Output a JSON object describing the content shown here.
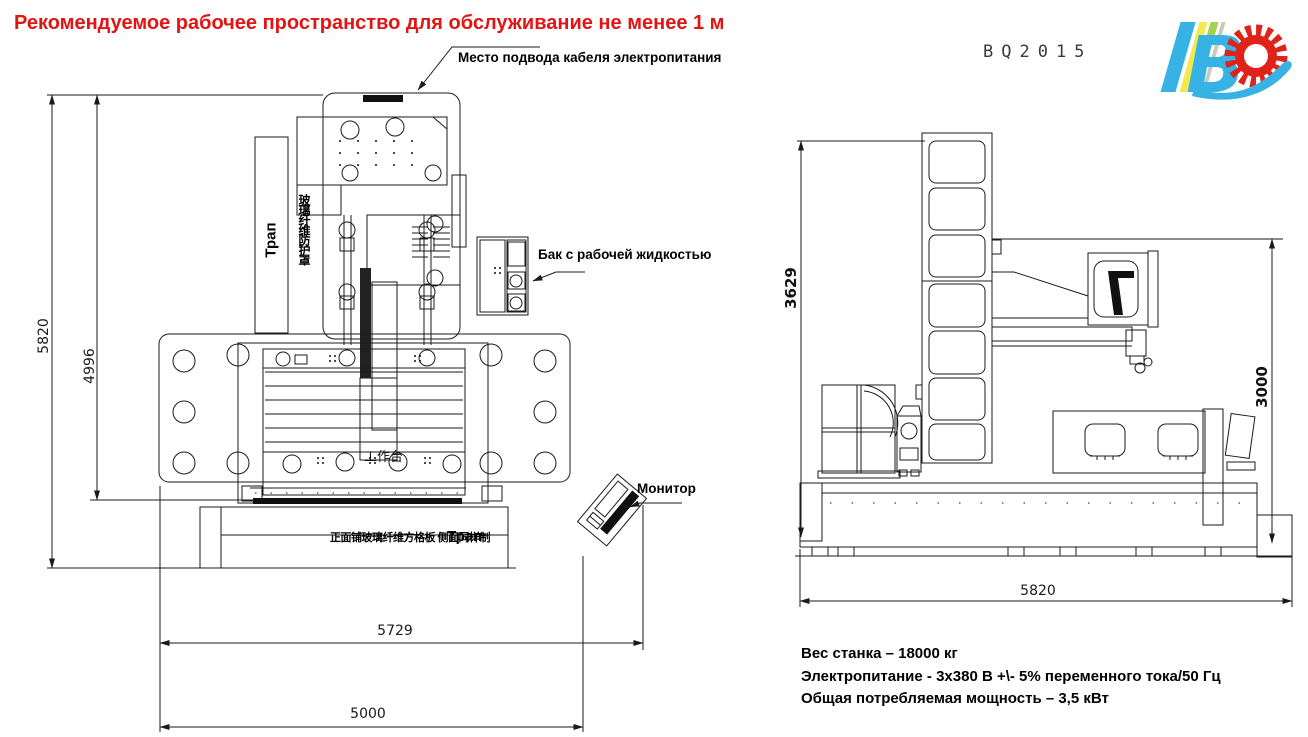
{
  "title": "Рекомендуемое рабочее пространство для обслуживание не менее 1 м",
  "model": "BQ2015",
  "logo": {
    "letter_b": "B"
  },
  "colors": {
    "title": "#e31414",
    "line": "#1a1a1a",
    "logo_blue": "#36b3e4",
    "logo_yellow": "#f2e94e",
    "logo_green": "#a4d44e",
    "logo_gray": "#c9c9c3",
    "logo_red": "#df2318"
  },
  "labels": {
    "cable": "Место подвода кабеля электропитания",
    "tank": "Бак с рабочей жидкостью",
    "monitor": "Монитор",
    "walkway_left": "Трап",
    "walkway_bottom": "Трап",
    "worktable_cn": "工作台",
    "column_cover_cn": "玻璃纤维防护罩",
    "base_note_cn": "正面铺玻璃纤维方格板 侧面同样制"
  },
  "front_view": {
    "dim_total_height": "5820",
    "dim_machine_height": "4996",
    "dim_workspace_width": "5729",
    "dim_base_width": "5000"
  },
  "side_view": {
    "dim_column_height": "3629",
    "dim_gantry_height": "3000",
    "dim_length": "5820"
  },
  "specs": [
    "Вес станка – 18000 кг",
    "Электропитание - 3х380 В +\\- 5% переменного тока/50 Гц",
    "Общая потребляемая мощность – 3,5 кВт"
  ]
}
